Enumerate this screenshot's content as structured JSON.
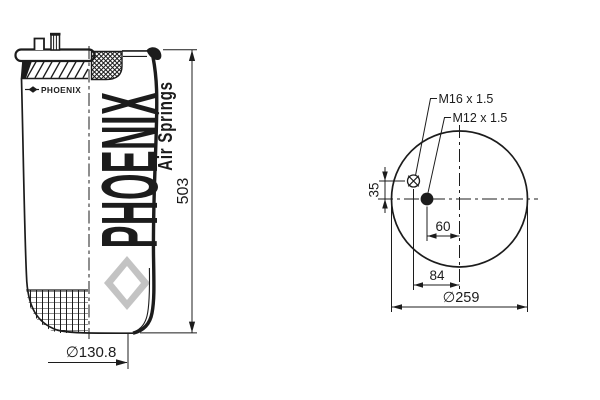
{
  "drawing": {
    "brand_logo": "PHOENIX",
    "watermark": {
      "word": "PHOENIX",
      "tagline": "Air Springs"
    },
    "side_view": {
      "dim_height": "503",
      "dim_bottom_diameter": "∅130.8"
    },
    "top_view": {
      "dim_outer_diameter": "∅259",
      "label_stud_thread": "M16 x 1.5",
      "label_center_thread": "M12 x 1.5",
      "dim_stud_vertical_offset": "35",
      "dim_center_horizontal_offset": "60",
      "dim_stud_horizontal_offset": "84",
      "markers": {
        "stud": "circle-with-cross",
        "air_port": "filled-circle"
      }
    },
    "colors": {
      "line": "#1c1c1c",
      "watermark_main": "#c3c3c3",
      "watermark_tagline": "#d0d0d0",
      "background": "#ffffff"
    }
  }
}
